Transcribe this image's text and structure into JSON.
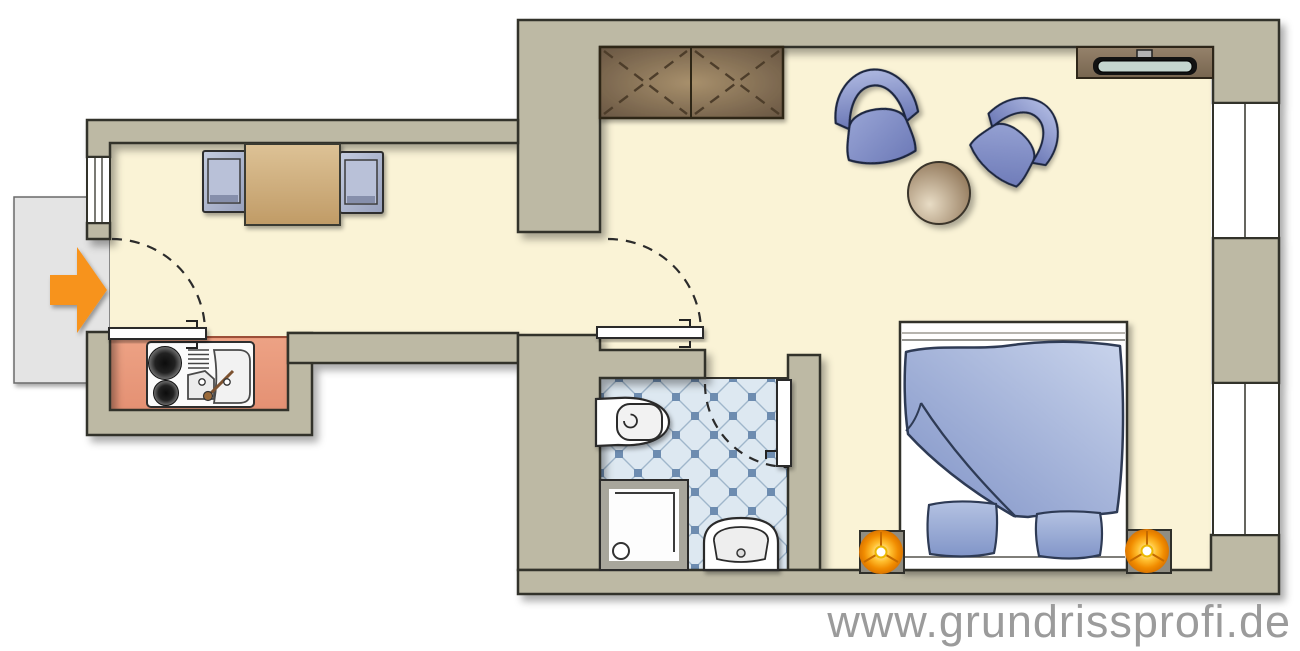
{
  "watermark": {
    "text": "www.grundrissprofi.de",
    "color": "#9b9b9b"
  },
  "colors": {
    "outside": "#ffffff",
    "wall": "#bdb9a4",
    "wall_outline": "#33322b",
    "floor": "#faf3d6",
    "kitchen_floor": "#e9997b",
    "kitchen_border": "#9c4f38",
    "tile_base": "#dde8f1",
    "tile_line": "#9fb6cb",
    "tile_dot": "#6d8cb0",
    "landing": "#e4e4e4",
    "arrow": "#f7931e",
    "furniture_blue": "#7f92c6",
    "furniture_blue_dark": "#6a77b5",
    "wood": "#c09b66",
    "wardrobe_wood": "#a8906c",
    "lamp_orange": "#f18c00",
    "tv_screen": "#c5d6cf",
    "bed_white": "#ffffff",
    "door_arc": "#2b2b2b"
  }
}
